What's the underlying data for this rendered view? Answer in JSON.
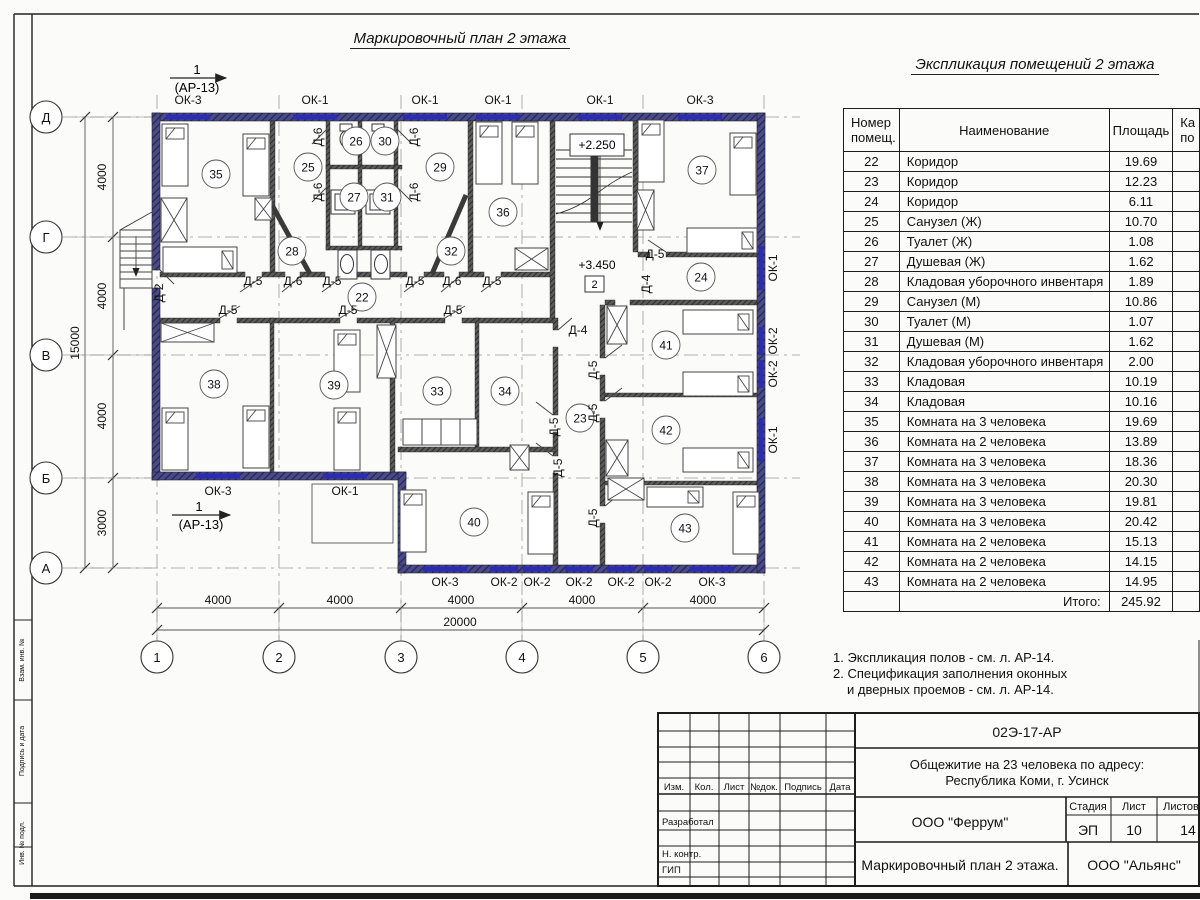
{
  "titles": {
    "plan": "Маркировочный план 2 этажа",
    "table": "Экспликация помещений 2 этажа"
  },
  "section_marker": {
    "num": "1",
    "ref": "(АР-13)"
  },
  "elevations": {
    "upper": "+2.250",
    "lower": "+3.450",
    "floor_box": "2"
  },
  "table": {
    "headers": {
      "col1a": "Номер",
      "col1b": "помещ.",
      "col2": "Наименование",
      "col3": "Площадь",
      "col4a": "Ка",
      "col4b": "по"
    },
    "rows": [
      [
        "22",
        "Коридор",
        "19.69"
      ],
      [
        "23",
        "Коридор",
        "12.23"
      ],
      [
        "24",
        "Коридор",
        "6.11"
      ],
      [
        "25",
        "Санузел (Ж)",
        "10.70"
      ],
      [
        "26",
        "Туалет (Ж)",
        "1.08"
      ],
      [
        "27",
        "Душевая (Ж)",
        "1.62"
      ],
      [
        "28",
        "Кладовая уборочного инвентаря",
        "1.89"
      ],
      [
        "29",
        "Санузел (М)",
        "10.86"
      ],
      [
        "30",
        "Туалет (М)",
        "1.07"
      ],
      [
        "31",
        "Душевая (М)",
        "1.62"
      ],
      [
        "32",
        "Кладовая уборочного инвентаря",
        "2.00"
      ],
      [
        "33",
        "Кладовая",
        "10.19"
      ],
      [
        "34",
        "Кладовая",
        "10.16"
      ],
      [
        "35",
        "Комната на 3 человека",
        "19.69"
      ],
      [
        "36",
        "Комната на 2 человека",
        "13.89"
      ],
      [
        "37",
        "Комната на 3 человека",
        "18.36"
      ],
      [
        "38",
        "Комната на 3 человека",
        "20.30"
      ],
      [
        "39",
        "Комната на 3 человека",
        "19.81"
      ],
      [
        "40",
        "Комната на 3 человека",
        "20.42"
      ],
      [
        "41",
        "Комната на 2 человека",
        "15.13"
      ],
      [
        "42",
        "Комната на 2 человека",
        "14.15"
      ],
      [
        "43",
        "Комната на 2 человека",
        "14.95"
      ]
    ],
    "total_label": "Итого:",
    "total_value": "245.92"
  },
  "notes": [
    "1. Экспликация полов - см. л. АР-14.",
    "2. Спецификация заполнения оконных",
    "и дверных проемов - см. л. АР-14."
  ],
  "plan": {
    "room_markers": [
      {
        "t": "35",
        "x": 216,
        "y": 174
      },
      {
        "t": "25",
        "x": 308,
        "y": 167
      },
      {
        "t": "26",
        "x": 356,
        "y": 141
      },
      {
        "t": "30",
        "x": 385,
        "y": 141
      },
      {
        "t": "29",
        "x": 440,
        "y": 167
      },
      {
        "t": "36",
        "x": 503,
        "y": 212
      },
      {
        "t": "37",
        "x": 702,
        "y": 170
      },
      {
        "t": "27",
        "x": 354,
        "y": 197
      },
      {
        "t": "31",
        "x": 387,
        "y": 197
      },
      {
        "t": "28",
        "x": 292,
        "y": 251
      },
      {
        "t": "32",
        "x": 451,
        "y": 251
      },
      {
        "t": "24",
        "x": 701,
        "y": 277
      },
      {
        "t": "22",
        "x": 362,
        "y": 297
      },
      {
        "t": "38",
        "x": 214,
        "y": 384
      },
      {
        "t": "39",
        "x": 334,
        "y": 385
      },
      {
        "t": "33",
        "x": 437,
        "y": 391
      },
      {
        "t": "34",
        "x": 505,
        "y": 391
      },
      {
        "t": "23",
        "x": 580,
        "y": 418
      },
      {
        "t": "41",
        "x": 666,
        "y": 345
      },
      {
        "t": "42",
        "x": 666,
        "y": 430
      },
      {
        "t": "40",
        "x": 474,
        "y": 522
      },
      {
        "t": "43",
        "x": 685,
        "y": 528
      }
    ],
    "window_labels": [
      {
        "t": "ОК-3",
        "x": 188,
        "y": 104,
        "r": 0
      },
      {
        "t": "ОК-1",
        "x": 315,
        "y": 104,
        "r": 0
      },
      {
        "t": "ОК-1",
        "x": 425,
        "y": 104,
        "r": 0
      },
      {
        "t": "ОК-1",
        "x": 498,
        "y": 104,
        "r": 0
      },
      {
        "t": "ОК-1",
        "x": 600,
        "y": 104,
        "r": 0
      },
      {
        "t": "ОК-3",
        "x": 700,
        "y": 104,
        "r": 0
      },
      {
        "t": "ОК-3",
        "x": 218,
        "y": 495,
        "r": 0
      },
      {
        "t": "ОК-1",
        "x": 345,
        "y": 495,
        "r": 0
      },
      {
        "t": "ОК-3",
        "x": 445,
        "y": 586,
        "r": 0
      },
      {
        "t": "ОК-2",
        "x": 504,
        "y": 586,
        "r": 0
      },
      {
        "t": "ОК-2",
        "x": 537,
        "y": 586,
        "r": 0
      },
      {
        "t": "ОК-2",
        "x": 579,
        "y": 586,
        "r": 0
      },
      {
        "t": "ОК-2",
        "x": 621,
        "y": 586,
        "r": 0
      },
      {
        "t": "ОК-2",
        "x": 658,
        "y": 586,
        "r": 0
      },
      {
        "t": "ОК-3",
        "x": 712,
        "y": 586,
        "r": 0
      },
      {
        "t": "ОК-1",
        "x": 777,
        "y": 268,
        "r": -90
      },
      {
        "t": "ОК-2",
        "x": 777,
        "y": 341,
        "r": -90
      },
      {
        "t": "ОК-2",
        "x": 777,
        "y": 374,
        "r": -90
      },
      {
        "t": "ОК-1",
        "x": 777,
        "y": 440,
        "r": -90
      }
    ],
    "door_labels": [
      {
        "t": "Д-5",
        "x": 253,
        "y": 285,
        "r": 0
      },
      {
        "t": "Д-6",
        "x": 293,
        "y": 285,
        "r": 0
      },
      {
        "t": "Д-5",
        "x": 332,
        "y": 285,
        "r": 0
      },
      {
        "t": "Д-5",
        "x": 415,
        "y": 285,
        "r": 0
      },
      {
        "t": "Д-6",
        "x": 452,
        "y": 285,
        "r": 0
      },
      {
        "t": "Д-5",
        "x": 492,
        "y": 285,
        "r": 0
      },
      {
        "t": "Д-5",
        "x": 228,
        "y": 314,
        "r": 0
      },
      {
        "t": "Д-5",
        "x": 348,
        "y": 314,
        "r": 0
      },
      {
        "t": "Д-5",
        "x": 453,
        "y": 314,
        "r": 0
      },
      {
        "t": "Д-5",
        "x": 655,
        "y": 258,
        "r": 0
      },
      {
        "t": "Д-4",
        "x": 578,
        "y": 334,
        "r": 0
      },
      {
        "t": "Д-6",
        "x": 322,
        "y": 137,
        "r": -90
      },
      {
        "t": "Д-6",
        "x": 418,
        "y": 137,
        "r": -90
      },
      {
        "t": "Д-6",
        "x": 322,
        "y": 192,
        "r": -90
      },
      {
        "t": "Д-6",
        "x": 418,
        "y": 192,
        "r": -90
      },
      {
        "t": "Д-2",
        "x": 163,
        "y": 293,
        "r": -90
      },
      {
        "t": "Д-4",
        "x": 650,
        "y": 284,
        "r": -90
      },
      {
        "t": "Д-5",
        "x": 597,
        "y": 370,
        "r": -90
      },
      {
        "t": "Д-5",
        "x": 597,
        "y": 413,
        "r": -90
      },
      {
        "t": "Д-5",
        "x": 558,
        "y": 427,
        "r": -90
      },
      {
        "t": "Д-5",
        "x": 562,
        "y": 468,
        "r": -90
      },
      {
        "t": "Д-5",
        "x": 597,
        "y": 518,
        "r": -90
      }
    ],
    "grid": {
      "rows": [
        {
          "t": "Д",
          "y": 117
        },
        {
          "t": "Г",
          "y": 237
        },
        {
          "t": "В",
          "y": 355
        },
        {
          "t": "Б",
          "y": 478
        },
        {
          "t": "А",
          "y": 568
        }
      ],
      "cols": [
        {
          "t": "1",
          "x": 157
        },
        {
          "t": "2",
          "x": 279
        },
        {
          "t": "3",
          "x": 401
        },
        {
          "t": "4",
          "x": 522
        },
        {
          "t": "5",
          "x": 643
        },
        {
          "t": "6",
          "x": 764
        }
      ]
    },
    "dims": {
      "left": [
        {
          "t": "4000",
          "y": 177
        },
        {
          "t": "4000",
          "y": 296
        },
        {
          "t": "4000",
          "y": 416
        },
        {
          "t": "3000",
          "y": 523
        }
      ],
      "left_total": "15000",
      "bottom": [
        {
          "t": "4000",
          "x": 218
        },
        {
          "t": "4000",
          "x": 340
        },
        {
          "t": "4000",
          "x": 461
        },
        {
          "t": "4000",
          "x": 582
        },
        {
          "t": "4000",
          "x": 703
        }
      ],
      "bottom_total": "20000"
    }
  },
  "titleblock": {
    "doc": "02Э-17-АР",
    "object1": "Общежитие на 23 человека по адресу:",
    "object2": "Республика Коми, г. Усинск",
    "firm": "ООО \"Феррум\"",
    "stage_label": "Стадия",
    "sheet_label": "Лист",
    "sheets_label": "Листов",
    "stage": "ЭП",
    "sheet": "10",
    "sheets": "14",
    "drawing": "Маркировочный план 2 этажа.",
    "firm2": "ООО \"Альянс\"",
    "cols": [
      "Изм.",
      "Кол.",
      "Лист",
      "№док.",
      "Подпись",
      "Дата"
    ],
    "roles": [
      "Разработал",
      "Н. контр.",
      "ГИП"
    ]
  },
  "border_labels": [
    "Взам. инв. №",
    "Подпись и дата",
    "Инв. № подл."
  ]
}
